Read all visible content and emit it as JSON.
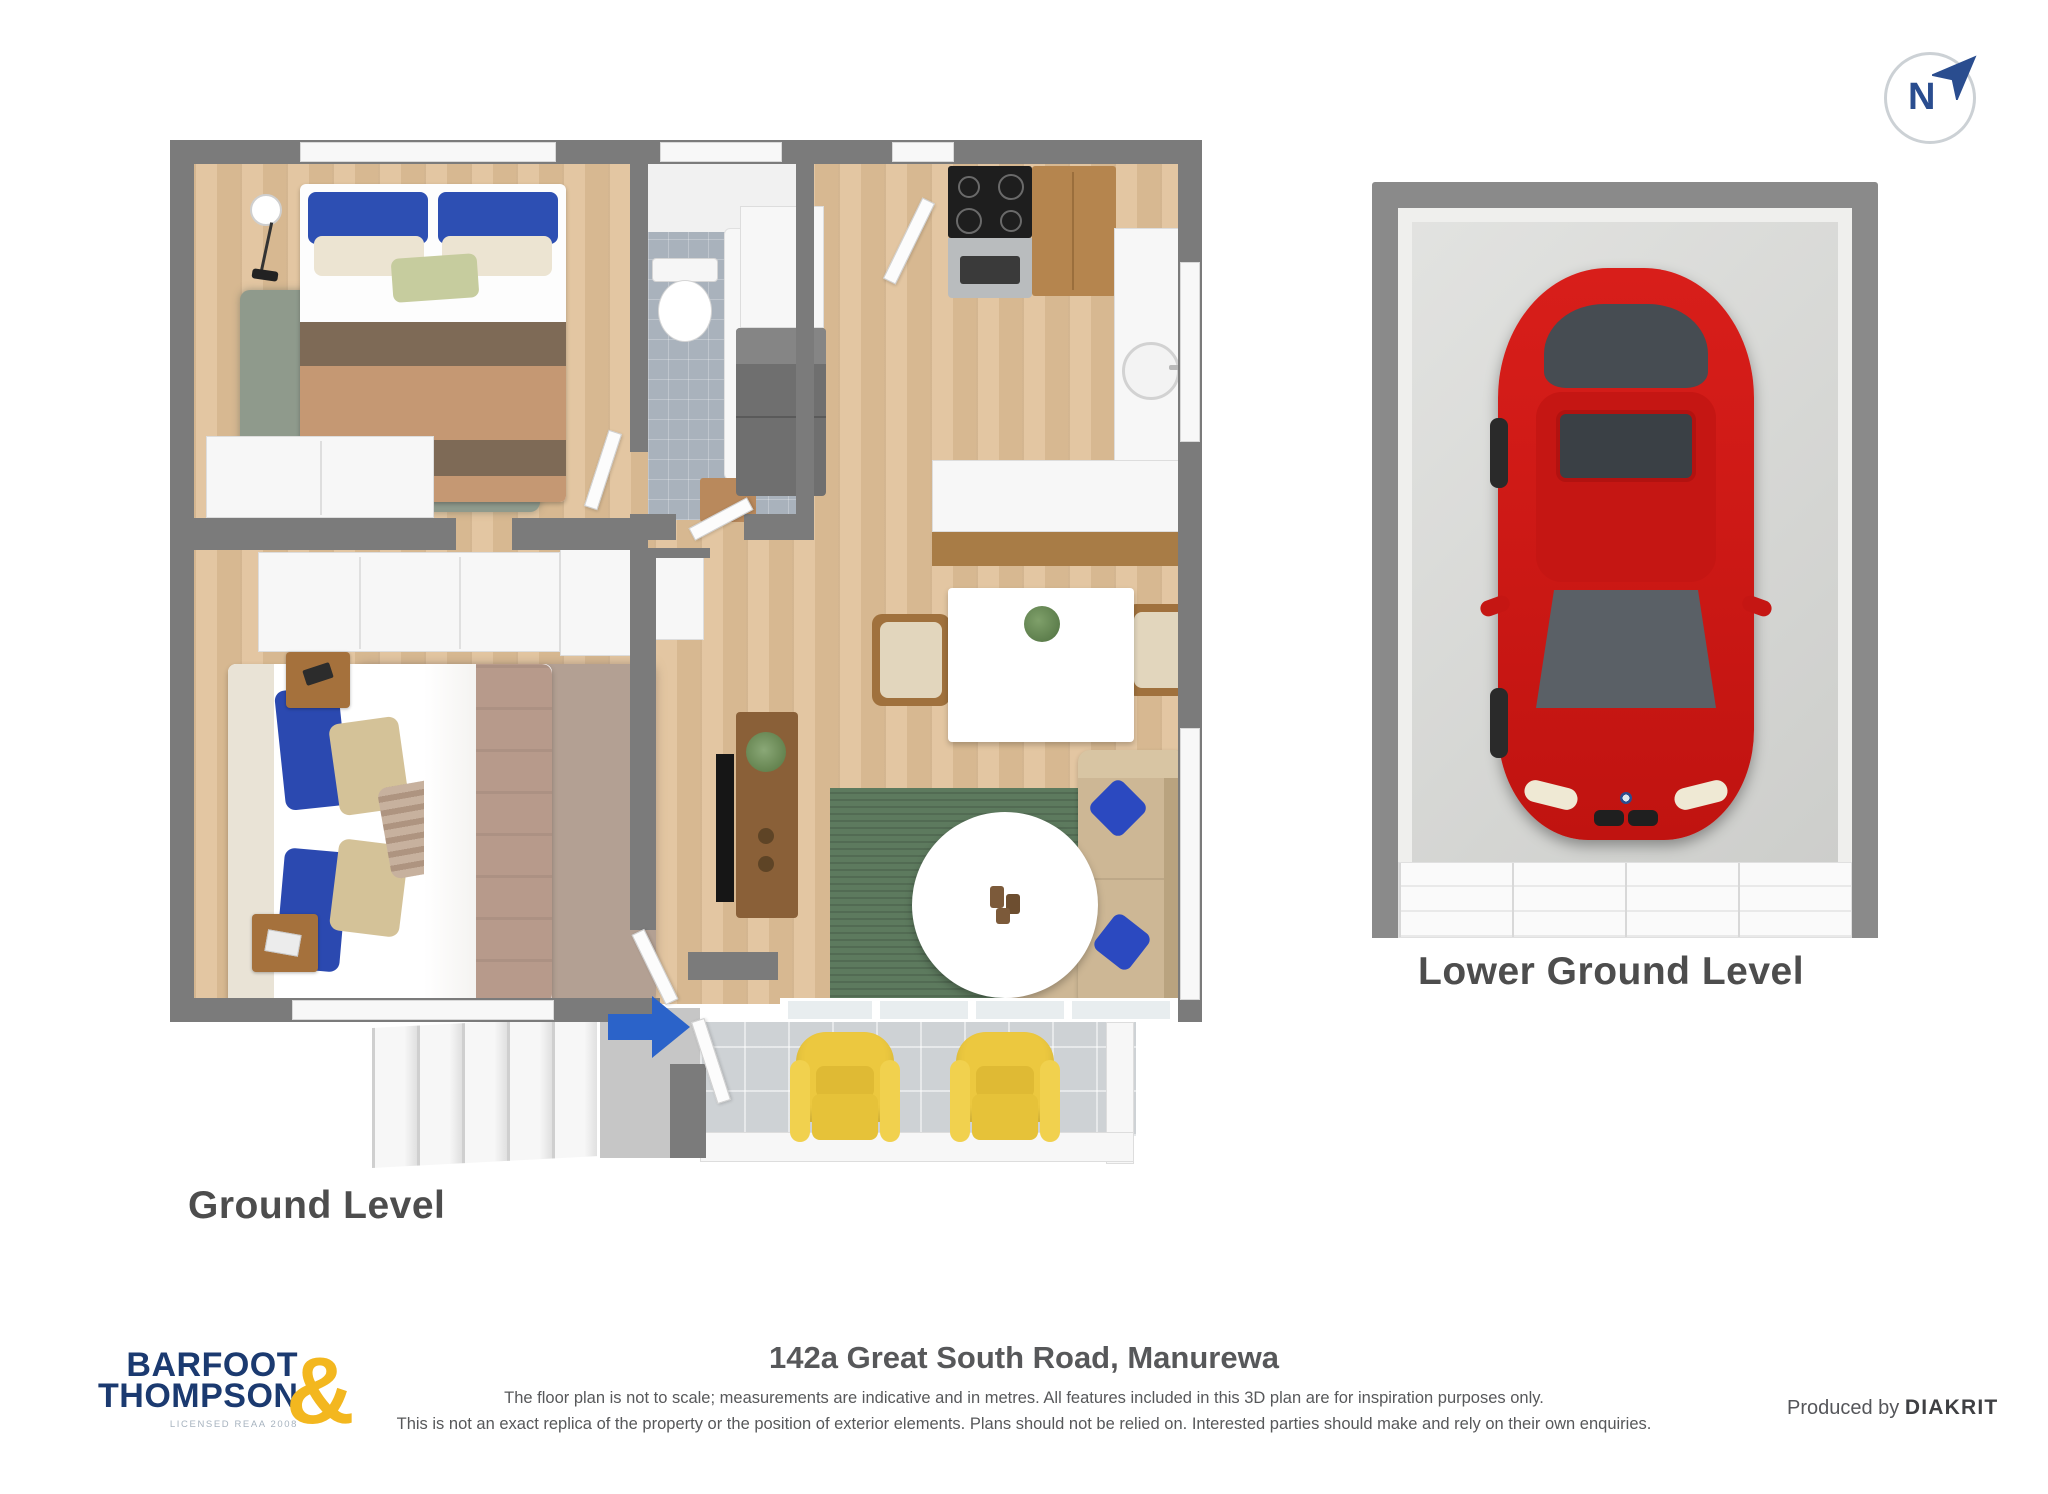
{
  "compass": {
    "label": "N"
  },
  "plans": {
    "ground": {
      "label": "Ground Level"
    },
    "lower_ground": {
      "label": "Lower Ground Level"
    }
  },
  "footer": {
    "address": "142a Great South Road, Manurewa",
    "disclaimer_lines": [
      "The floor plan is not to scale; measurements are indicative and in metres. All features included in this 3D plan are for inspiration purposes only.",
      "This is not an exact replica of the property or the position of exterior elements. Plans should not be relied on. Interested parties should make and rely on their own enquiries."
    ],
    "produced_by_prefix": "Produced by",
    "producer_name": "DIAKRIT"
  },
  "logo": {
    "line1": "BARFOOT",
    "line2": "THOMPSON",
    "ampersand": "&",
    "license_text": "LICENSED REAA 2008"
  },
  "colors": {
    "wall_gray": "#7b7b7b",
    "floor_wood": "#e0c097",
    "bathroom_tile": "#a9b2bc",
    "porch_tile": "#ced2d5",
    "rug_green": "#5d7a5e",
    "rug_master": "#b3a093",
    "rug_bedroom2": "#8f9a8c",
    "pillow_blue": "#2d4fb3",
    "duvet_master": "#b79a8b",
    "duvet_brown": "#7e6a56",
    "duvet_tan": "#c59873",
    "sofa_beige": "#cdb795",
    "armchair_yellow": "#ecc83f",
    "entry_arrow_blue": "#2b63c9",
    "car_red": "#cf1a17",
    "logo_navy": "#1b3a70",
    "logo_gold": "#f3b71f",
    "heading_gray": "#4d4d4d",
    "compass_blue": "#2a4d8f"
  }
}
